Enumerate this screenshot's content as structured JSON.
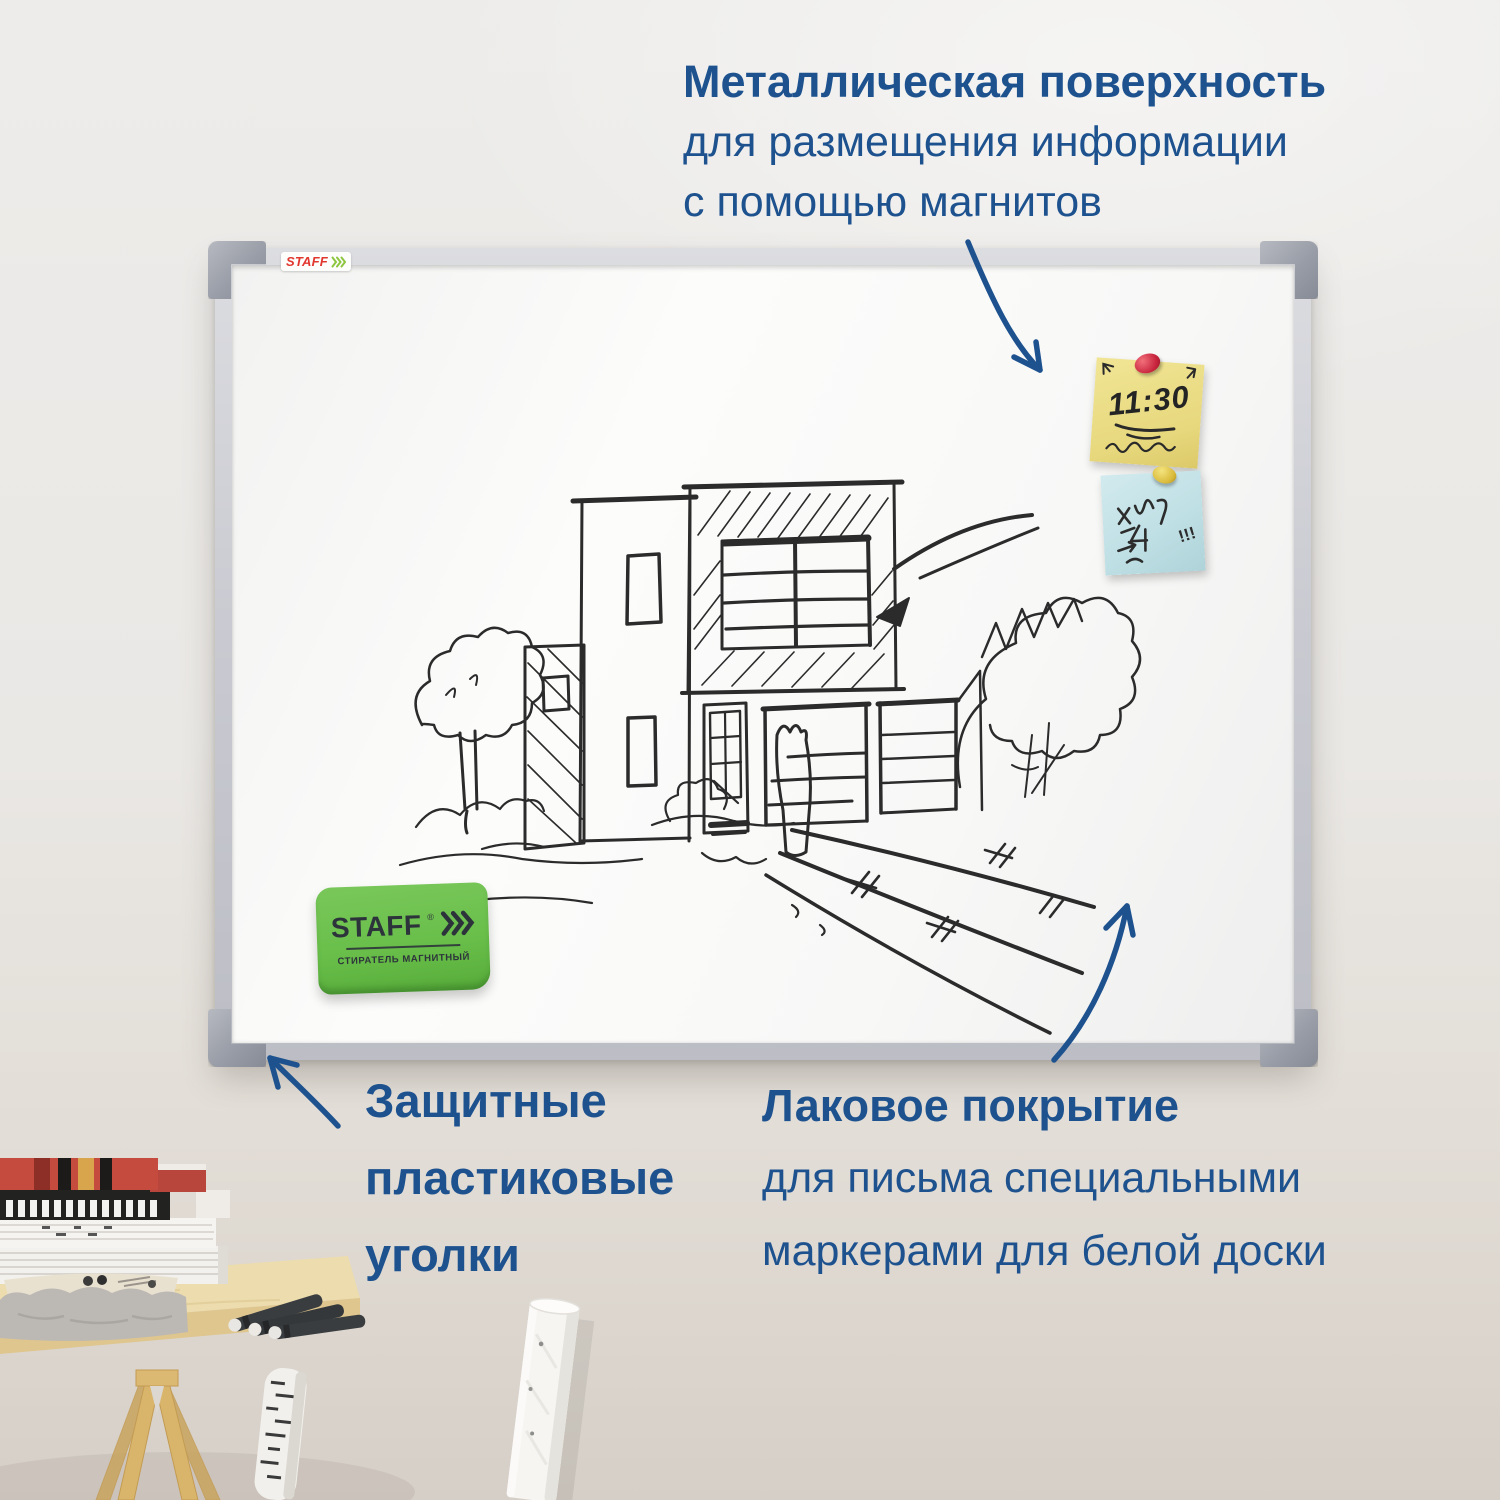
{
  "captions": {
    "surface": {
      "title": "Металлическая поверхность",
      "line1": "для размещения информации",
      "line2": "с помощью магнитов"
    },
    "corners": {
      "line1": "Защитные",
      "line2": "пластиковые",
      "line3": "уголки"
    },
    "coating": {
      "title": "Лаковое покрытие",
      "line1": "для письма специальными",
      "line2": "маркерами для белой доски"
    }
  },
  "board": {
    "sticker_brand": "STAFF",
    "eraser": {
      "brand": "STAFF",
      "reg": "®",
      "label": "СТИРАТЕЛЬ МАГНИТНЫЙ"
    },
    "notes": {
      "yellow_text": "11:30",
      "blue_text": "!!!"
    }
  },
  "icons": {
    "surface_arrow": "curved-arrow-icon",
    "corners_arrow": "curved-arrow-icon",
    "coating_arrow": "curved-arrow-icon",
    "yellow_note_pin": "push-pin-icon",
    "blue_note_pin": "push-pin-icon",
    "brand_chevrons": "triple-chevron-icon"
  },
  "colors": {
    "annotation_blue": "#1d528f",
    "eraser_green": "#69bf4a",
    "staff_logo_red": "#e2372e",
    "staff_chevron_green": "#8dc63f",
    "note_yellow": "#eadf8c",
    "note_blue": "#c3e2e7",
    "pin_red": "#c7233c",
    "pin_yellow": "#d9ba3a",
    "frame_silver": "#c9cad1",
    "corner_gray": "#999da7",
    "wall": "#e9e7e4",
    "desk_wood": "#ecdcae"
  }
}
